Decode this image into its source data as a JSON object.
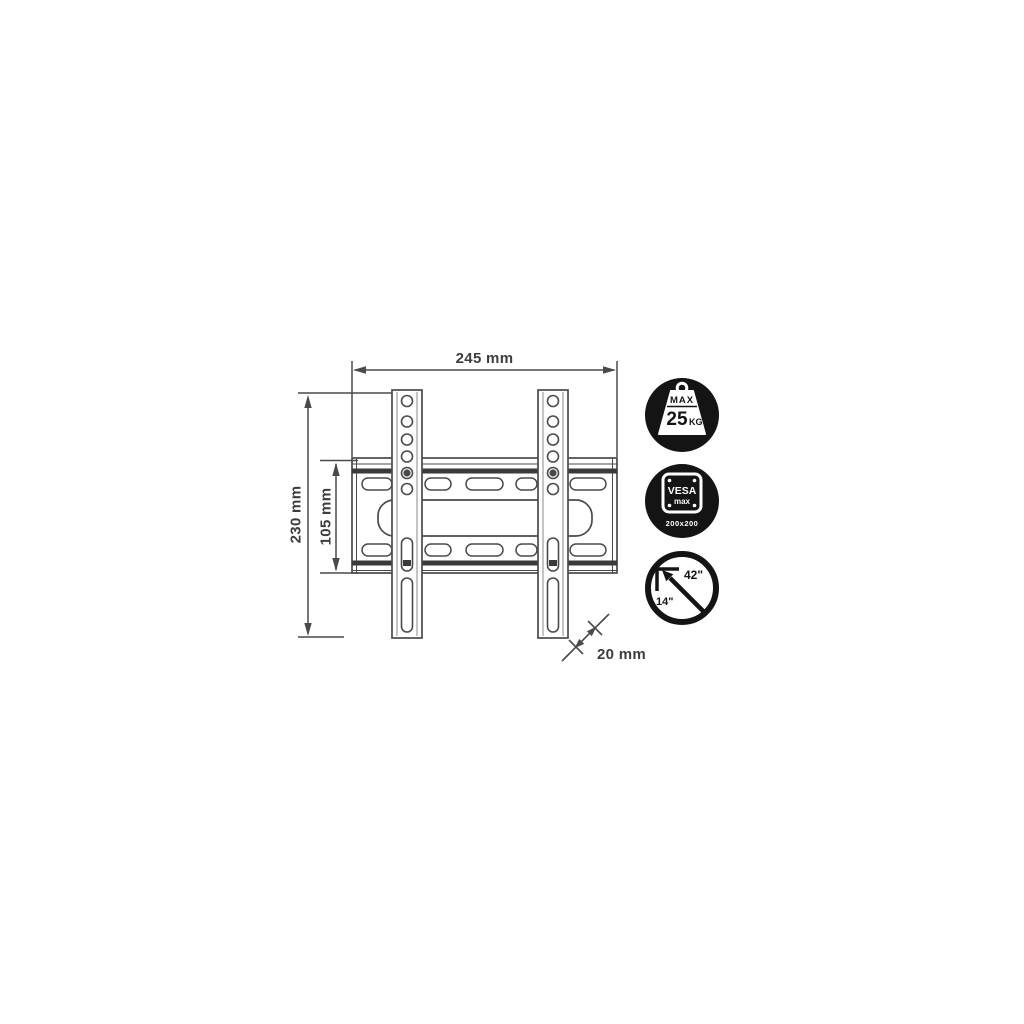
{
  "diagram": {
    "title": "tv-wall-mount-bracket-technical-drawing",
    "dimensions": {
      "width": "245 mm",
      "height": "230 mm",
      "plate_height": "105 mm",
      "depth": "20 mm"
    },
    "badges": {
      "max_weight": {
        "label": "MAX",
        "value": "25",
        "unit": "KG"
      },
      "vesa": {
        "name": "VESA",
        "qualifier": "max",
        "pattern": "200x200"
      },
      "screen_size": {
        "max_diagonal": "42\"",
        "min_diagonal": "14\""
      }
    },
    "colors": {
      "line": "#4a4a4a",
      "accent_band": "#3a3a3a",
      "text": "#3d3d3d",
      "badge_background": "#141414",
      "badge_foreground": "#ffffff",
      "canvas": "#ffffff"
    }
  }
}
